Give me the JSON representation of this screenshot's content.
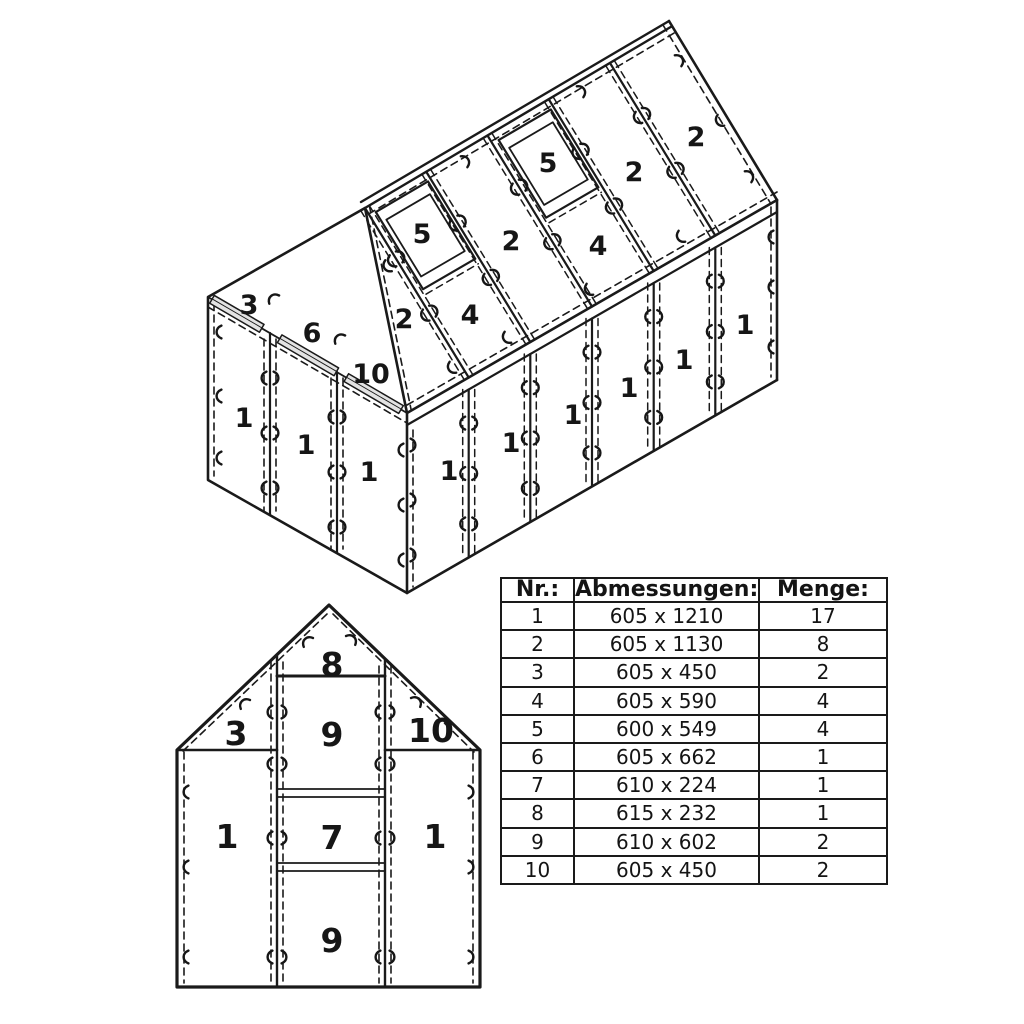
{
  "doc": {
    "type": "greenhouse hollow-panel assembly diagram",
    "background": "#ffffff",
    "line_color": "#1a1a1a",
    "dash_color": "#b6b6b6",
    "bar_fill": "#e3e3e3"
  },
  "iso_view": {
    "roof_labels": [
      {
        "text": "2",
        "x": 404,
        "y": 328
      },
      {
        "text": "5",
        "x": 422,
        "y": 243
      },
      {
        "text": "4",
        "x": 470,
        "y": 324
      },
      {
        "text": "2",
        "x": 511,
        "y": 250
      },
      {
        "text": "5",
        "x": 548,
        "y": 172
      },
      {
        "text": "4",
        "x": 598,
        "y": 255
      },
      {
        "text": "2",
        "x": 634,
        "y": 181
      },
      {
        "text": "2",
        "x": 696,
        "y": 146
      }
    ],
    "gable_labels": [
      {
        "text": "3",
        "x": 249,
        "y": 314
      },
      {
        "text": "6",
        "x": 312,
        "y": 342
      },
      {
        "text": "10",
        "x": 371,
        "y": 383
      },
      {
        "text": "1",
        "x": 244,
        "y": 427
      },
      {
        "text": "1",
        "x": 306,
        "y": 454
      },
      {
        "text": "1",
        "x": 369,
        "y": 481
      }
    ],
    "wall_labels": [
      {
        "text": "1",
        "x": 449,
        "y": 480
      },
      {
        "text": "1",
        "x": 511,
        "y": 452
      },
      {
        "text": "1",
        "x": 573,
        "y": 424
      },
      {
        "text": "1",
        "x": 629,
        "y": 397
      },
      {
        "text": "1",
        "x": 684,
        "y": 369
      },
      {
        "text": "1",
        "x": 745,
        "y": 334
      }
    ]
  },
  "front_view": {
    "labels": [
      {
        "text": "8",
        "x": 332,
        "y": 676
      },
      {
        "text": "9",
        "x": 332,
        "y": 746
      },
      {
        "text": "3",
        "x": 236,
        "y": 745
      },
      {
        "text": "10",
        "x": 431,
        "y": 742
      },
      {
        "text": "1",
        "x": 227,
        "y": 848
      },
      {
        "text": "7",
        "x": 332,
        "y": 849
      },
      {
        "text": "1",
        "x": 435,
        "y": 848
      },
      {
        "text": "9",
        "x": 332,
        "y": 952
      }
    ]
  },
  "table": {
    "headers": [
      "Nr.:",
      "Abmessungen:",
      "Menge:"
    ],
    "rows": [
      [
        "1",
        "605 x 1210",
        "17"
      ],
      [
        "2",
        "605 x 1130",
        "8"
      ],
      [
        "3",
        "605 x 450",
        "2"
      ],
      [
        "4",
        "605 x 590",
        "4"
      ],
      [
        "5",
        "600 x 549",
        "4"
      ],
      [
        "6",
        "605 x 662",
        "1"
      ],
      [
        "7",
        "610 x 224",
        "1"
      ],
      [
        "8",
        "615 x 232",
        "1"
      ],
      [
        "9",
        "610 x 602",
        "2"
      ],
      [
        "10",
        "605 x 450",
        "2"
      ]
    ]
  }
}
